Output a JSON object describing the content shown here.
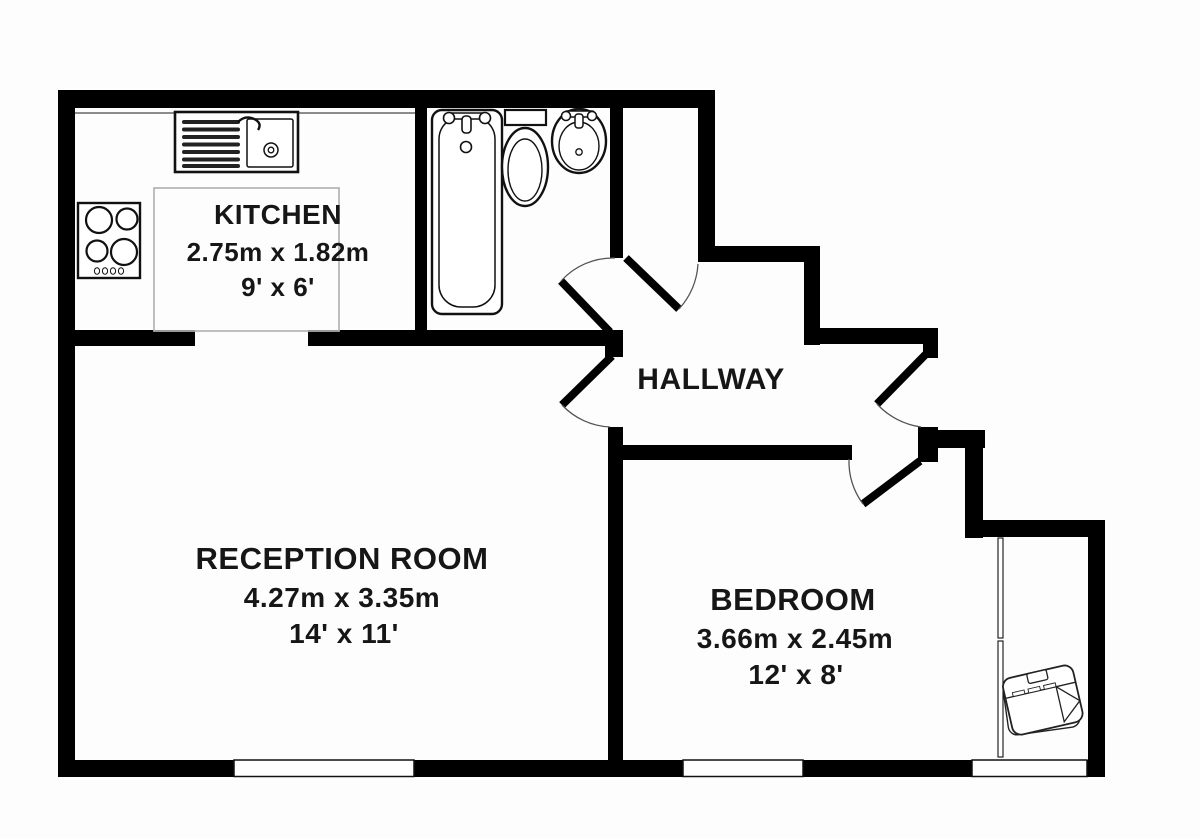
{
  "plan": {
    "title": "Flat floor plan",
    "rooms": {
      "kitchen": {
        "name": "KITCHEN",
        "metric": "2.75m x 1.82m",
        "imperial": "9' x 6'"
      },
      "hallway": {
        "name": "HALLWAY"
      },
      "reception": {
        "name": "RECEPTION ROOM",
        "metric": "4.27m x 3.35m",
        "imperial": "14' x 11'"
      },
      "bedroom": {
        "name": "BEDROOM",
        "metric": "3.66m x 2.45m",
        "imperial": "12' x 8'"
      }
    },
    "fixtures": [
      "kitchen-sink-drainer",
      "four-ring-hob",
      "bath",
      "toilet",
      "wash-basin",
      "sofa"
    ],
    "door_count": 5,
    "window_count": 4,
    "colors": {
      "wall": "#000000",
      "fixture-line": "#1a1a1a",
      "door-arc": "#555555",
      "kitchen-area-outline": "#b3b3b3",
      "text": "#161616",
      "background": "#fdfdfd"
    }
  }
}
